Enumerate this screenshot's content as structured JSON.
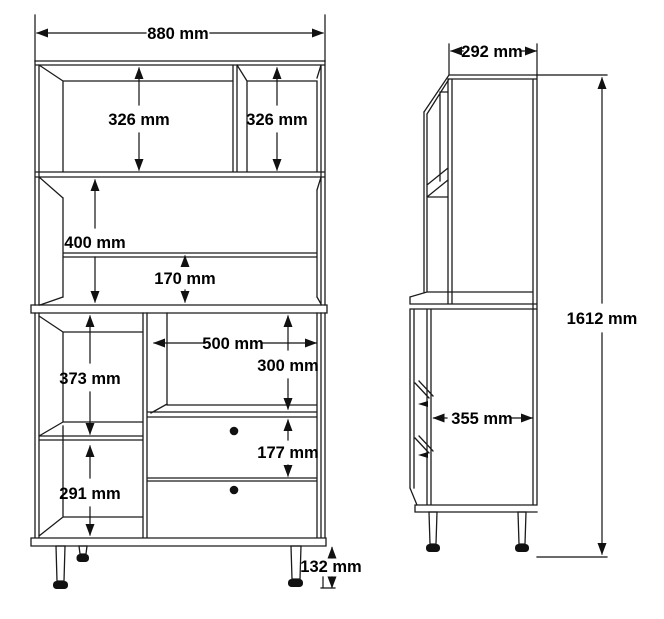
{
  "drawing": {
    "front_view": {
      "overall_width": "880 mm",
      "top_left_compartment_height": "326 mm",
      "top_right_compartment_height": "326 mm",
      "middle_compartment_height": "400 mm",
      "back_rail_height": "170 mm",
      "upper_left_compartment_height": "373 mm",
      "open_shelf_width": "500 mm",
      "open_shelf_height": "300 mm",
      "drawer_height": "177 mm",
      "lower_left_compartment_height": "291 mm",
      "leg_height": "132 mm"
    },
    "side_view": {
      "top_depth": "292 mm",
      "total_height": "1612 mm",
      "body_depth": "355 mm"
    },
    "colors": {
      "line": "#1b1b1b",
      "background": "#ffffff",
      "knob": "#111111"
    }
  }
}
